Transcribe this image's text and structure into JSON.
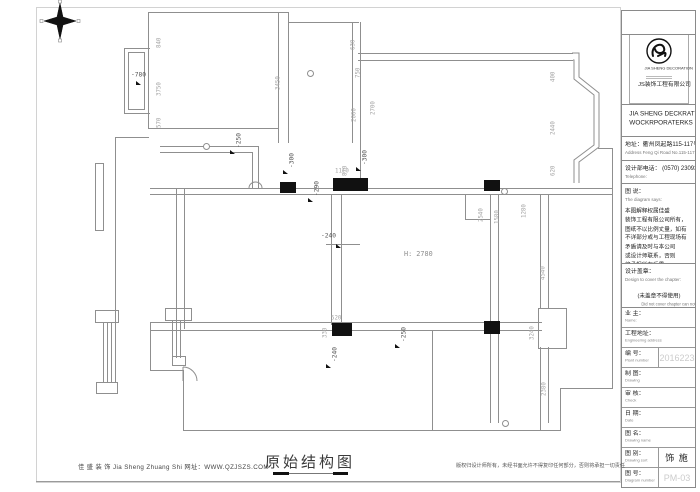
{
  "sheet": {
    "footer_left": "佳 盛 装 饰 Jia Sheng Zhuang Shi    网址：WWW.QZJSZS.COM",
    "title": "原始结构图",
    "footer_right": "版权归设计师所有，未经书面允许不得复印任何部分，否则将承担一切责任"
  },
  "title_block": {
    "logo_small_text": "JIA SHENG DECORATION",
    "logo_company": "JS装饰工程有限公司",
    "company_line1": "JIA SHENG DECKRATE",
    "company_line2": "WOCKRPORATERKS",
    "address_cn": "地址：衢州凤起路115-117号",
    "address_en": "Address Feng Qi Road No.115-117",
    "phone_cn": "设计部电话：  (0570) 2309348",
    "phone_en": "Telephone:",
    "diagram_label_cn": "图 说：",
    "diagram_label_en": "The diagram says:",
    "diagram_text": "本图解释权属佳盛\n装饰工程有限公司所有，\n图纸不以比例丈量，如有\n不详部分或与工程现场有\n矛盾请及时与本公司\n或设计师联系，否则\n将承担所有后果。",
    "stamp_label_cn": "设计盖章：",
    "stamp_label_en": "Design to cover the chapter:",
    "stamp_note_cn": "(未盖章不得使用)",
    "stamp_note_en": "Did not cover chapter can not use",
    "rows": [
      {
        "label": "业 主：",
        "sub": "Name:",
        "value": ""
      },
      {
        "label": "工程地址：",
        "sub": "Engineering address",
        "value": ""
      },
      {
        "label": "编 号：",
        "sub": "Plant number",
        "value": "2016223",
        "ghost": true
      },
      {
        "label": "制 图：",
        "sub": "Drawing",
        "value": ""
      },
      {
        "label": "审 核：",
        "sub": "Check",
        "value": ""
      },
      {
        "label": "日 期：",
        "sub": "Date",
        "value": ""
      },
      {
        "label": "图 名：",
        "sub": "Drawing name",
        "value": ""
      },
      {
        "label": "图 别：",
        "sub": "Drawing sort",
        "value": "饰 施",
        "ghost": false
      },
      {
        "label": "图 号：",
        "sub": "Diagram number",
        "value": "PM-03",
        "ghost": true
      }
    ]
  },
  "plan": {
    "height_label": "H: 2780",
    "walls": [
      [
        148,
        12,
        141,
        1
      ],
      [
        148,
        12,
        1,
        117
      ],
      [
        278,
        12,
        1,
        131
      ],
      [
        288,
        12,
        1,
        131
      ],
      [
        148,
        128,
        131,
        1
      ],
      [
        124,
        48,
        26,
        1
      ],
      [
        124,
        113,
        26,
        1
      ],
      [
        124,
        48,
        1,
        66
      ],
      [
        128,
        52,
        1,
        58
      ],
      [
        144,
        52,
        1,
        58
      ],
      [
        128,
        52,
        17,
        1
      ],
      [
        128,
        109,
        17,
        1
      ],
      [
        288,
        22,
        71,
        1
      ],
      [
        352,
        22,
        1,
        121
      ],
      [
        360,
        22,
        1,
        161
      ],
      [
        358,
        53,
        215,
        1
      ],
      [
        358,
        60,
        215,
        1
      ],
      [
        150,
        188,
        463,
        1
      ],
      [
        150,
        194,
        463,
        1
      ],
      [
        115,
        137,
        1,
        189
      ],
      [
        115,
        137,
        34,
        1
      ],
      [
        95,
        163,
        1,
        68
      ],
      [
        103,
        163,
        1,
        68
      ],
      [
        95,
        163,
        9,
        1
      ],
      [
        95,
        230,
        9,
        1
      ],
      [
        160,
        146,
        98,
        1
      ],
      [
        160,
        152,
        92,
        1
      ],
      [
        252,
        152,
        1,
        37
      ],
      [
        258,
        146,
        1,
        43
      ],
      [
        331,
        194,
        1,
        131
      ],
      [
        341,
        194,
        1,
        131
      ],
      [
        176,
        188,
        1,
        141
      ],
      [
        184,
        188,
        1,
        141
      ],
      [
        150,
        322,
        392,
        1
      ],
      [
        150,
        330,
        392,
        1
      ],
      [
        150,
        322,
        1,
        49
      ],
      [
        150,
        370,
        34,
        1
      ],
      [
        183,
        370,
        1,
        61
      ],
      [
        183,
        430,
        378,
        1
      ],
      [
        560,
        389,
        1,
        42
      ],
      [
        560,
        388,
        53,
        1
      ],
      [
        612,
        148,
        1,
        241
      ],
      [
        598,
        148,
        15,
        1
      ],
      [
        432,
        330,
        1,
        101
      ],
      [
        490,
        194,
        1,
        229
      ],
      [
        498,
        194,
        1,
        229
      ],
      [
        540,
        194,
        1,
        115
      ],
      [
        548,
        194,
        1,
        115
      ],
      [
        540,
        347,
        1,
        84
      ],
      [
        548,
        347,
        1,
        76
      ],
      [
        465,
        194,
        1,
        26
      ],
      [
        465,
        219,
        26,
        1
      ],
      [
        326,
        244,
        34,
        1
      ],
      [
        95,
        310,
        24,
        1
      ],
      [
        95,
        310,
        1,
        13
      ],
      [
        118,
        310,
        1,
        13
      ],
      [
        95,
        322,
        24,
        1
      ],
      [
        103,
        322,
        1,
        61
      ],
      [
        107,
        322,
        1,
        61
      ],
      [
        111,
        322,
        1,
        61
      ],
      [
        115,
        322,
        1,
        61
      ],
      [
        96,
        382,
        22,
        1
      ],
      [
        96,
        393,
        22,
        1
      ],
      [
        96,
        382,
        1,
        12
      ],
      [
        117,
        382,
        1,
        12
      ],
      [
        165,
        308,
        27,
        1
      ],
      [
        165,
        308,
        1,
        13
      ],
      [
        191,
        308,
        1,
        13
      ],
      [
        165,
        320,
        27,
        1
      ],
      [
        172,
        320,
        1,
        38
      ],
      [
        176,
        320,
        1,
        38
      ],
      [
        180,
        320,
        1,
        38
      ],
      [
        172,
        356,
        14,
        1
      ],
      [
        172,
        365,
        14,
        1
      ],
      [
        172,
        356,
        1,
        10
      ],
      [
        185,
        356,
        1,
        10
      ]
    ],
    "columns": [
      [
        280,
        182,
        16,
        11
      ],
      [
        333,
        178,
        35,
        13
      ],
      [
        484,
        180,
        16,
        11
      ],
      [
        332,
        323,
        20,
        13
      ],
      [
        484,
        321,
        16,
        13
      ]
    ],
    "dims": [
      [
        "840",
        156,
        48,
        1
      ],
      [
        "3750",
        156,
        96,
        1
      ],
      [
        "570",
        156,
        128,
        1
      ],
      [
        "3450",
        275,
        90,
        1
      ],
      [
        "630",
        350,
        50,
        1
      ],
      [
        "750",
        355,
        78,
        1
      ],
      [
        "2000",
        351,
        122,
        1
      ],
      [
        "2700",
        370,
        115,
        1
      ],
      [
        "400",
        550,
        82,
        1
      ],
      [
        "2440",
        550,
        135,
        1
      ],
      [
        "620",
        550,
        176,
        1
      ],
      [
        "870",
        342,
        176,
        1
      ],
      [
        "1110",
        335,
        168,
        0
      ],
      [
        "2540",
        478,
        222,
        1
      ],
      [
        "1580",
        494,
        224,
        1
      ],
      [
        "1280",
        521,
        218,
        1
      ],
      [
        "4540",
        540,
        280,
        1
      ],
      [
        "3240",
        529,
        340,
        1
      ],
      [
        "2380",
        541,
        396,
        1
      ],
      [
        "520",
        331,
        315,
        0
      ],
      [
        "330",
        322,
        338,
        1
      ]
    ],
    "flags": [
      [
        "-780",
        131,
        72,
        0
      ],
      [
        "-250",
        236,
        148,
        1
      ],
      [
        "-300",
        289,
        168,
        1
      ],
      [
        "-300",
        362,
        165,
        1
      ],
      [
        "-290",
        314,
        196,
        1
      ],
      [
        "-240",
        321,
        233,
        0
      ],
      [
        "-240",
        332,
        362,
        1
      ],
      [
        "-250",
        401,
        342,
        1
      ]
    ],
    "flag_tris": [
      [
        136,
        81
      ],
      [
        230,
        150
      ],
      [
        283,
        170
      ],
      [
        356,
        167
      ],
      [
        308,
        198
      ],
      [
        336,
        244
      ],
      [
        326,
        364
      ],
      [
        395,
        344
      ]
    ],
    "circles": [
      [
        203,
        143
      ],
      [
        307,
        70
      ],
      [
        501,
        188
      ],
      [
        502,
        420
      ]
    ]
  }
}
